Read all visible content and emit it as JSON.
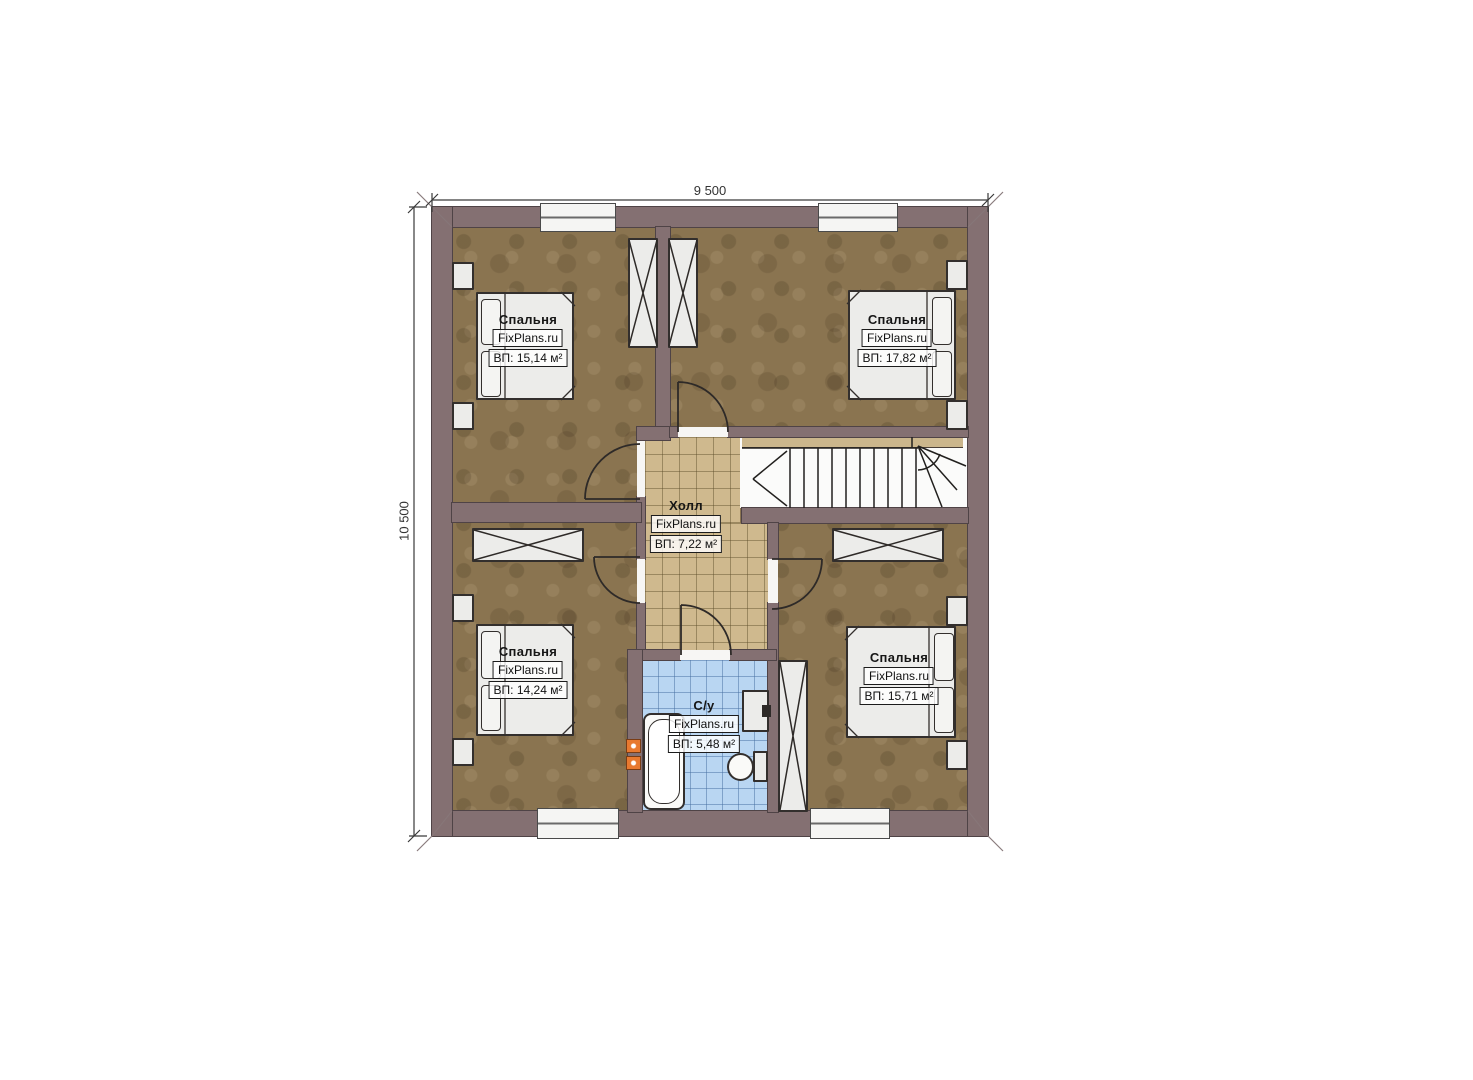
{
  "dimensions": {
    "width_label": "9 500",
    "height_label": "10 500"
  },
  "rooms": [
    {
      "id": "bedroom-top-left",
      "name": "Спальня",
      "watermark": "FixPlans.ru",
      "area": "ВП: 15,14 м²"
    },
    {
      "id": "bedroom-top-right",
      "name": "Спальня",
      "watermark": "FixPlans.ru",
      "area": "ВП: 17,82 м²"
    },
    {
      "id": "hall",
      "name": "Холл",
      "watermark": "FixPlans.ru",
      "area": "ВП: 7,22 м²"
    },
    {
      "id": "bedroom-bottom-left",
      "name": "Спальня",
      "watermark": "FixPlans.ru",
      "area": "ВП: 14,24 м²"
    },
    {
      "id": "bathroom",
      "name": "С/у",
      "watermark": "FixPlans.ru",
      "area": "ВП: 5,48 м²"
    },
    {
      "id": "bedroom-bottom-right",
      "name": "Спальня",
      "watermark": "FixPlans.ru",
      "area": "ВП: 15,71 м²"
    }
  ],
  "colors": {
    "wall": "#847072",
    "floor": "#8a7450",
    "hall_tile": "#cfb98e",
    "bath_tile": "#b9d6f2",
    "accent_orange": "#e8792f"
  }
}
